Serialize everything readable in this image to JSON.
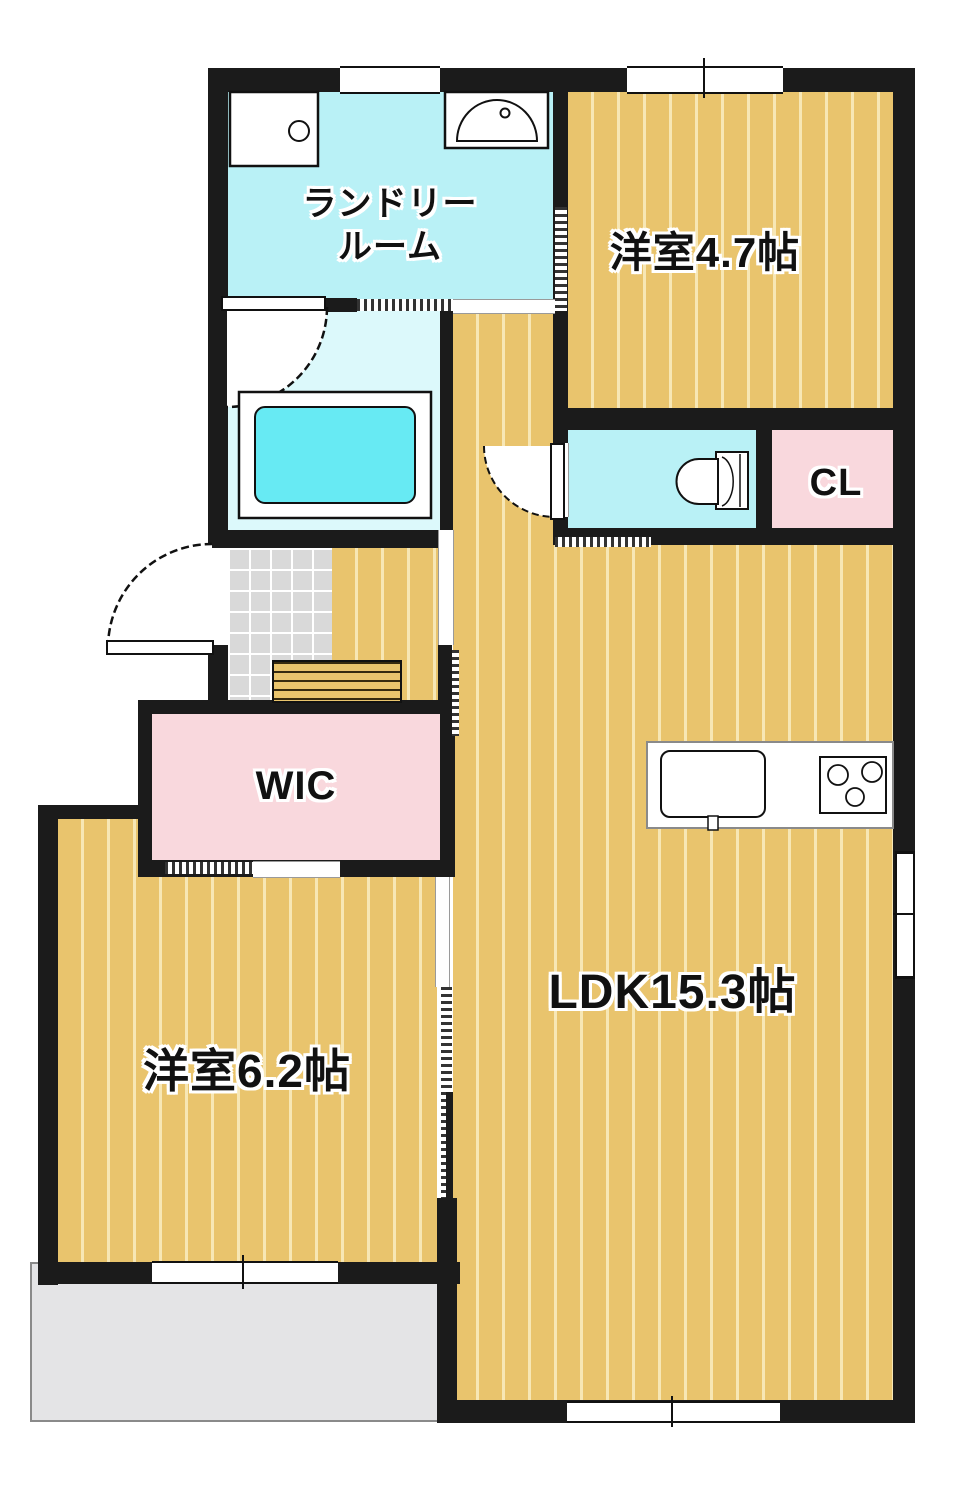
{
  "rooms": {
    "laundry": {
      "line1": "ランドリー",
      "line2": "ルーム"
    },
    "bedroom47": {
      "label": "洋室4.7帖"
    },
    "cl": {
      "label": "CL"
    },
    "wic": {
      "label": "WIC"
    },
    "bedroom62": {
      "label": "洋室6.2帖"
    },
    "ldk": {
      "label": "LDK15.3帖"
    }
  },
  "colors": {
    "wall": "#1b1b1b",
    "wood_floor": "#e9c46d",
    "wood_stripe": "#f7e7b5",
    "wet_area_cyan": "#b9f1f6",
    "bath_floor": "#dcf9fb",
    "bathtub_fill": "#67eaf3",
    "closet_pink": "#f9d8dd",
    "entrance_tile": "#d9d9d9",
    "balcony_gray": "#e4e4e6"
  },
  "icons": [
    "washing-machine-icon",
    "sink-icon",
    "bathtub-icon",
    "toilet-icon",
    "kitchen-sink-icon",
    "stove-icon",
    "door-arc",
    "window"
  ]
}
